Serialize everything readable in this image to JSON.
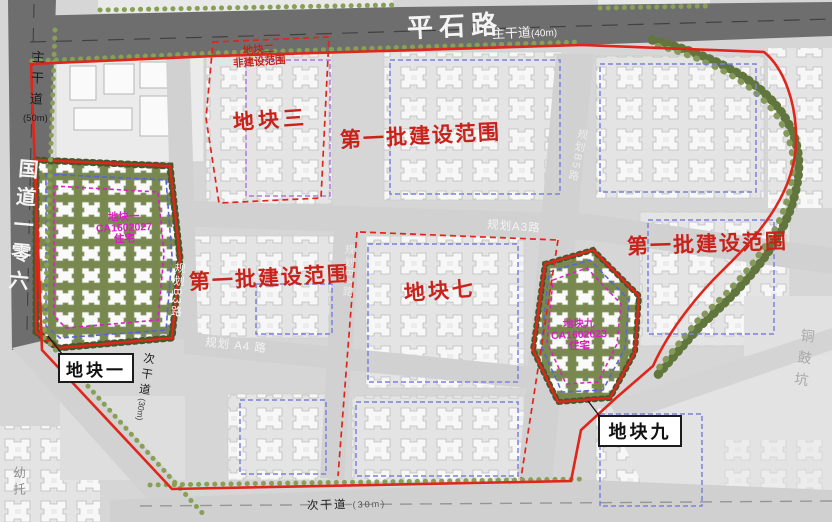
{
  "colors": {
    "scope_red": "#e0251a",
    "text_red": "#c8221a",
    "magenta": "#db1cc5",
    "blue_dash": "#7a82da",
    "road_dark": "#6e6e6e",
    "plot_green": "#78884f"
  },
  "roads": {
    "pingshi": "平石路",
    "pingshi_type": "主干道",
    "pingshi_type_width": "(40m)",
    "left_type": "主干道",
    "left_width": "(50m)",
    "guodao": "国道一零六",
    "b3": "规划B3路",
    "b4": "规划B4路",
    "a3": "规划A3路",
    "a4": "规划 A4 路",
    "b5": "规划B5路",
    "secondary": "次干道",
    "secondary_width": "(30m)",
    "secondary_left": "次干道",
    "secondary_left_width": "(30m)"
  },
  "labels": {
    "plot2_l1": "地块二",
    "plot2_l2": "非建设范围",
    "plot3": "地块三",
    "scope_top": "第一批建设范围",
    "scope_left": "第一批建设范围",
    "scope_right": "第一批建设范围",
    "plot7": "地块七",
    "plot1_box": "地块一",
    "plot9_box": "地块九",
    "kindergarten": "幼托",
    "tonggukeng": "铜鼓坑"
  },
  "plot_tags": {
    "plot1": {
      "name": "地块一",
      "code": "CA1602027",
      "use": "住宅"
    },
    "plot9": {
      "name": "地块九",
      "code": "CA1602023",
      "use": "住宅"
    }
  }
}
